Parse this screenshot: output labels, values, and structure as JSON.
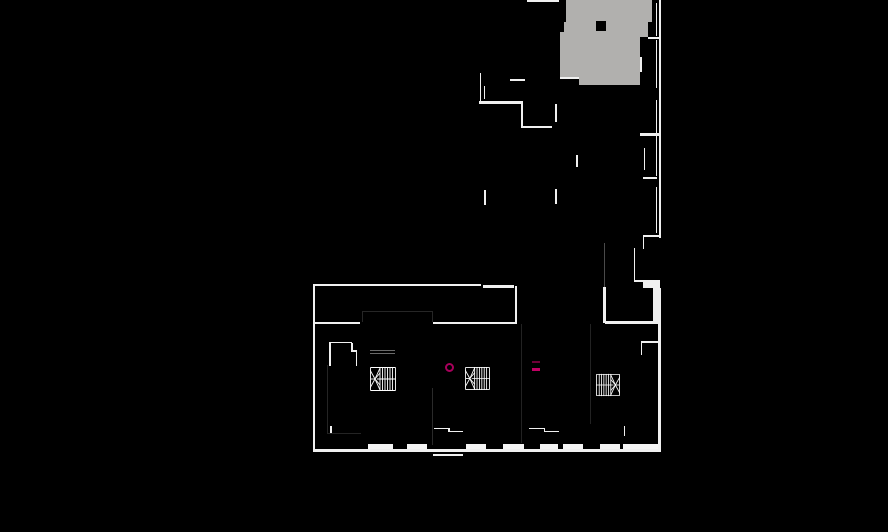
{
  "canvas": {
    "width": 888,
    "height": 532,
    "background": "#000000"
  },
  "palette": {
    "wall": "#f0f0f0",
    "roof_gray": "#b1b0ae",
    "hole_black": "#000000",
    "marker_magenta": "#a8005c",
    "marker_magenta_dim": "#6f0038",
    "marker_magenta_bright": "#c10063",
    "faint_gray": "#4a4a4a"
  },
  "plan": {
    "roof_areas": [
      {
        "x": 566,
        "y": 0,
        "w": 86,
        "h": 22
      },
      {
        "x": 564,
        "y": 22,
        "w": 84,
        "h": 15
      },
      {
        "x": 560,
        "y": 32,
        "w": 80,
        "h": 46
      },
      {
        "x": 579,
        "y": 77,
        "w": 61,
        "h": 8
      }
    ],
    "holes": [
      {
        "x": 596,
        "y": 21,
        "w": 10,
        "h": 10
      },
      {
        "x": 657.5,
        "y": 88,
        "w": 4,
        "h": 12
      }
    ],
    "walls": [
      {
        "x": 527,
        "y": 0,
        "w": 32,
        "h": 2
      },
      {
        "x": 479.5,
        "y": 73,
        "w": 1.5,
        "h": 29
      },
      {
        "x": 483.5,
        "y": 86,
        "w": 1.5,
        "h": 13
      },
      {
        "x": 510,
        "y": 79,
        "w": 15,
        "h": 2
      },
      {
        "x": 479,
        "y": 101,
        "w": 44,
        "h": 2.5
      },
      {
        "x": 521,
        "y": 103.5,
        "w": 2,
        "h": 24
      },
      {
        "x": 523,
        "y": 126,
        "w": 29,
        "h": 2
      },
      {
        "x": 555,
        "y": 104,
        "w": 1.5,
        "h": 18
      },
      {
        "x": 555,
        "y": 189,
        "w": 1.5,
        "h": 15
      },
      {
        "x": 484,
        "y": 190,
        "w": 1.5,
        "h": 15
      },
      {
        "x": 576,
        "y": 155,
        "w": 1.5,
        "h": 12
      },
      {
        "x": 560,
        "y": 77,
        "w": 19,
        "h": 2
      },
      {
        "x": 658.5,
        "y": 0,
        "w": 2,
        "h": 238
      },
      {
        "x": 655.5,
        "y": 3,
        "w": 1.5,
        "h": 33
      },
      {
        "x": 655.5,
        "y": 40,
        "w": 1.5,
        "h": 48
      },
      {
        "x": 655.5,
        "y": 100,
        "w": 1.5,
        "h": 33
      },
      {
        "x": 655.5,
        "y": 136,
        "w": 1.5,
        "h": 40
      },
      {
        "x": 655.5,
        "y": 187,
        "w": 1.5,
        "h": 46
      },
      {
        "x": 648,
        "y": 36.5,
        "w": 12,
        "h": 2
      },
      {
        "x": 640,
        "y": 133,
        "w": 20,
        "h": 2.5
      },
      {
        "x": 643,
        "y": 177,
        "w": 14,
        "h": 2
      },
      {
        "x": 643,
        "y": 234.5,
        "w": 17,
        "h": 2.5
      },
      {
        "x": 640,
        "y": 57,
        "w": 1.5,
        "h": 15
      },
      {
        "x": 643.5,
        "y": 148,
        "w": 1.5,
        "h": 22
      },
      {
        "x": 642.5,
        "y": 237,
        "w": 1.5,
        "h": 12
      },
      {
        "x": 633.5,
        "y": 248,
        "w": 1.5,
        "h": 32
      },
      {
        "x": 633.5,
        "y": 279.5,
        "w": 12,
        "h": 2
      },
      {
        "x": 643,
        "y": 280,
        "w": 17,
        "h": 8
      },
      {
        "x": 652.5,
        "y": 287.5,
        "w": 8,
        "h": 36
      },
      {
        "x": 483,
        "y": 285,
        "w": 31,
        "h": 2.5
      },
      {
        "x": 514.5,
        "y": 286,
        "w": 2.5,
        "h": 38
      },
      {
        "x": 602.5,
        "y": 287,
        "w": 3,
        "h": 36
      },
      {
        "x": 605,
        "y": 321,
        "w": 54,
        "h": 2.5
      },
      {
        "x": 313,
        "y": 283.5,
        "w": 168,
        "h": 2.5
      },
      {
        "x": 312.5,
        "y": 283.5,
        "w": 2.5,
        "h": 168
      },
      {
        "x": 315,
        "y": 321.5,
        "w": 45,
        "h": 2.5
      },
      {
        "x": 433,
        "y": 321.5,
        "w": 83,
        "h": 2.5
      },
      {
        "x": 658,
        "y": 321,
        "w": 2.5,
        "h": 130
      },
      {
        "x": 312.5,
        "y": 448.5,
        "w": 348.5,
        "h": 3
      },
      {
        "x": 433.5,
        "y": 427.5,
        "w": 15,
        "h": 1.5
      },
      {
        "x": 448,
        "y": 427.5,
        "w": 1.5,
        "h": 4.5
      },
      {
        "x": 448,
        "y": 430.5,
        "w": 15,
        "h": 1.5
      },
      {
        "x": 529,
        "y": 427.5,
        "w": 15,
        "h": 1.5
      },
      {
        "x": 543.5,
        "y": 427.5,
        "w": 1.5,
        "h": 4.5
      },
      {
        "x": 543.5,
        "y": 430.5,
        "w": 15,
        "h": 1.5
      },
      {
        "x": 433,
        "y": 454,
        "w": 30,
        "h": 1.5
      },
      {
        "x": 330,
        "y": 425.5,
        "w": 1.5,
        "h": 8
      },
      {
        "x": 623.5,
        "y": 425.5,
        "w": 1.5,
        "h": 10
      },
      {
        "x": 329,
        "y": 341.5,
        "w": 23,
        "h": 1.5
      },
      {
        "x": 329,
        "y": 341.5,
        "w": 1.5,
        "h": 24
      },
      {
        "x": 350.5,
        "y": 343,
        "w": 2,
        "h": 8.5
      },
      {
        "x": 350.5,
        "y": 350,
        "w": 6.5,
        "h": 2
      },
      {
        "x": 355.5,
        "y": 350,
        "w": 1.5,
        "h": 15.5
      },
      {
        "x": 642,
        "y": 340.5,
        "w": 17,
        "h": 2
      },
      {
        "x": 640.5,
        "y": 340.5,
        "w": 1.5,
        "h": 14.5
      }
    ],
    "window_sills": [
      {
        "x": 368,
        "y": 443.5,
        "w": 25,
        "h": 5
      },
      {
        "x": 407,
        "y": 443.5,
        "w": 20,
        "h": 5
      },
      {
        "x": 466,
        "y": 443.5,
        "w": 20,
        "h": 5
      },
      {
        "x": 503,
        "y": 443.5,
        "w": 21,
        "h": 5
      },
      {
        "x": 540,
        "y": 443.5,
        "w": 18,
        "h": 5
      },
      {
        "x": 563,
        "y": 443.5,
        "w": 20,
        "h": 5
      },
      {
        "x": 600,
        "y": 443.5,
        "w": 20,
        "h": 5
      },
      {
        "x": 623,
        "y": 443.5,
        "w": 35,
        "h": 5
      }
    ],
    "faint_walls": [
      {
        "x": 370,
        "y": 350,
        "w": 25,
        "h": 1,
        "c": "#6a6a6a"
      },
      {
        "x": 370,
        "y": 352.5,
        "w": 25,
        "h": 1,
        "c": "#6a6a6a"
      },
      {
        "x": 603.5,
        "y": 243,
        "w": 1,
        "h": 44,
        "c": "#4a4a4a"
      },
      {
        "x": 326.5,
        "y": 365,
        "w": 1,
        "h": 68,
        "c": "#242424"
      },
      {
        "x": 327,
        "y": 432.5,
        "w": 34,
        "h": 1,
        "c": "#242424"
      },
      {
        "x": 431.5,
        "y": 388,
        "w": 1,
        "h": 57,
        "c": "#2a2a2a"
      },
      {
        "x": 521,
        "y": 324,
        "w": 1,
        "h": 119,
        "c": "#222222"
      },
      {
        "x": 589.5,
        "y": 324,
        "w": 1,
        "h": 100,
        "c": "#222222"
      },
      {
        "x": 361.5,
        "y": 311,
        "w": 71,
        "h": 1,
        "c": "#262626"
      },
      {
        "x": 361.5,
        "y": 311,
        "w": 1,
        "h": 11,
        "c": "#262626"
      },
      {
        "x": 432,
        "y": 311,
        "w": 1,
        "h": 11,
        "c": "#262626"
      }
    ],
    "stairs": [
      {
        "x": 370,
        "y": 366.5,
        "w": 26,
        "h": 24,
        "mirrored": false
      },
      {
        "x": 465,
        "y": 367,
        "w": 25,
        "h": 23,
        "mirrored": false
      },
      {
        "x": 595.5,
        "y": 372.5,
        "w": 24,
        "h": 24,
        "mirrored": true
      }
    ],
    "markers": {
      "ring": {
        "x": 444.5,
        "y": 362.5,
        "d": 9,
        "stroke": 2.5,
        "color": "#a8005c"
      },
      "dashes": [
        {
          "x": 531.5,
          "y": 360.5,
          "w": 8,
          "h": 2,
          "color": "#6f0038"
        },
        {
          "x": 531.5,
          "y": 367.5,
          "w": 8,
          "h": 3,
          "color": "#c10063"
        }
      ]
    }
  }
}
